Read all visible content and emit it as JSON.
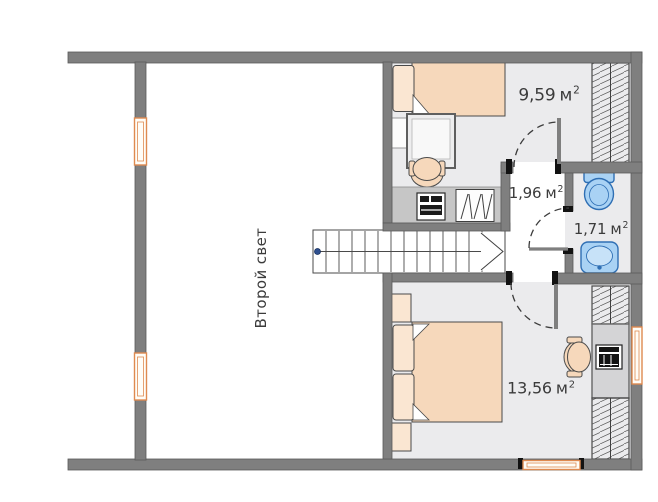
{
  "labels": {
    "second_light": "Второй свет",
    "bedroom_top": {
      "value": "9,59",
      "unit": "м",
      "sup": "2"
    },
    "hallway": {
      "value": "1,96",
      "unit": "м",
      "sup": "2"
    },
    "bathroom": {
      "value": "1,71",
      "unit": "м",
      "sup": "2"
    },
    "bedroom_bottom": {
      "value": "13,56",
      "unit": "м",
      "sup": "2"
    }
  },
  "fixtures": {
    "stairs": "stairs-with-direction-arrow",
    "bed_top": "single-bed",
    "bed_bottom": "double-bed",
    "bathroom": [
      "toilet",
      "sink"
    ],
    "storage": [
      "wardrobe-hatched",
      "counter-with-washing-machine"
    ],
    "windows": 4,
    "doors": 3
  },
  "colors": {
    "wall": "#7f7f7f",
    "floor": "#ebebed",
    "furn": "#f6d8bb",
    "pillow": "#fae6d2",
    "window": "#df8a50",
    "fixture": "#a9d2f4",
    "fixtureStroke": "#2f6fb4",
    "counter": "#c6c6c6",
    "desk": "#d4d4d6",
    "text": "#3b3b3b",
    "dot": "#2e4f8f"
  }
}
